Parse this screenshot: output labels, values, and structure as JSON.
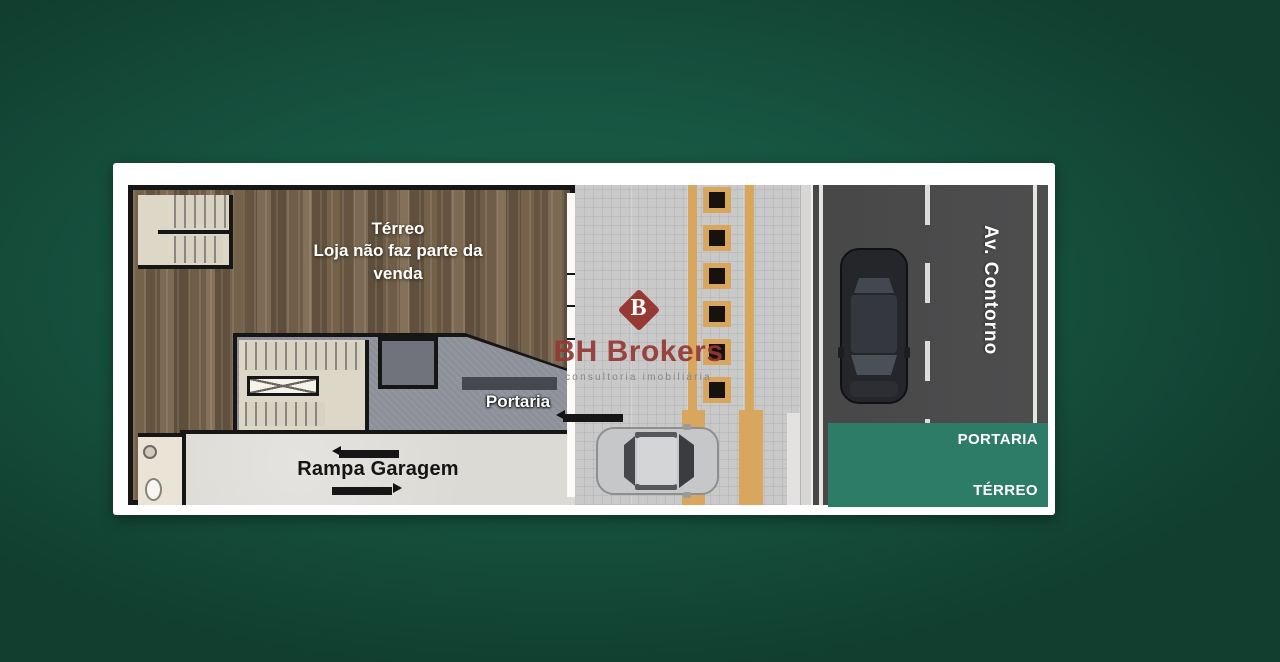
{
  "plan": {
    "floor_title": "Térreo",
    "floor_note": "Loja não faz parte da venda",
    "reception_label": "Portaria",
    "ramp_label": "Rampa Garagem"
  },
  "brand": {
    "logo_letter": "B",
    "name": "BH Brokers",
    "tagline": "consultoria imobiliária"
  },
  "street": {
    "name": "Av. Contorno"
  },
  "info_box": {
    "top_label": "PORTARIA",
    "bottom_label": "TÉRREO"
  },
  "colors": {
    "background_green": "#165541",
    "info_box_teal": "#2C7C68",
    "brand_maroon": "#963834",
    "tactile_orange": "#D8A65C",
    "road_gray": "#4A4A4B",
    "wall_black": "#161616"
  }
}
